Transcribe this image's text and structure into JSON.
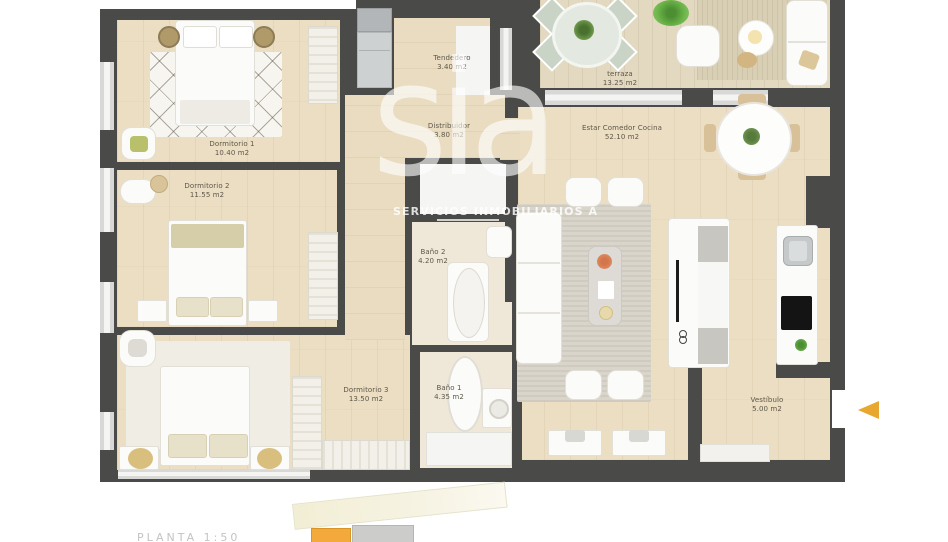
{
  "plan": {
    "rooms": [
      {
        "name": "Dormitorio 1",
        "area": "10.40 m2"
      },
      {
        "name": "Dormitorio 2",
        "area": "11.55 m2"
      },
      {
        "name": "Dormitorio 3",
        "area": "13.50 m2"
      },
      {
        "name": "Tendedero",
        "area": "3.40 m2"
      },
      {
        "name": "Distribuidor",
        "area": "3.80 m2"
      },
      {
        "name": "Baño 2",
        "area": "4.20 m2"
      },
      {
        "name": "Baño 1",
        "area": "4.35 m2"
      },
      {
        "name": "terraza",
        "area": "13.25 m2"
      },
      {
        "name": "Estar Comedor Cocina",
        "area": "52.10 m2"
      },
      {
        "name": "Vestíbulo",
        "area": "5.00 m2"
      }
    ],
    "watermark": {
      "logo": "sia",
      "tagline": "SERVICIOS INMOBILIARIOS A"
    },
    "footer": {
      "scale_label": "PLANTA 1:50"
    },
    "colors": {
      "wall": "#4a4a49",
      "wood": "#ebdec3",
      "entrance_arrow": "#e8a72f",
      "keyplan_highlight": "#f3a93c"
    }
  }
}
